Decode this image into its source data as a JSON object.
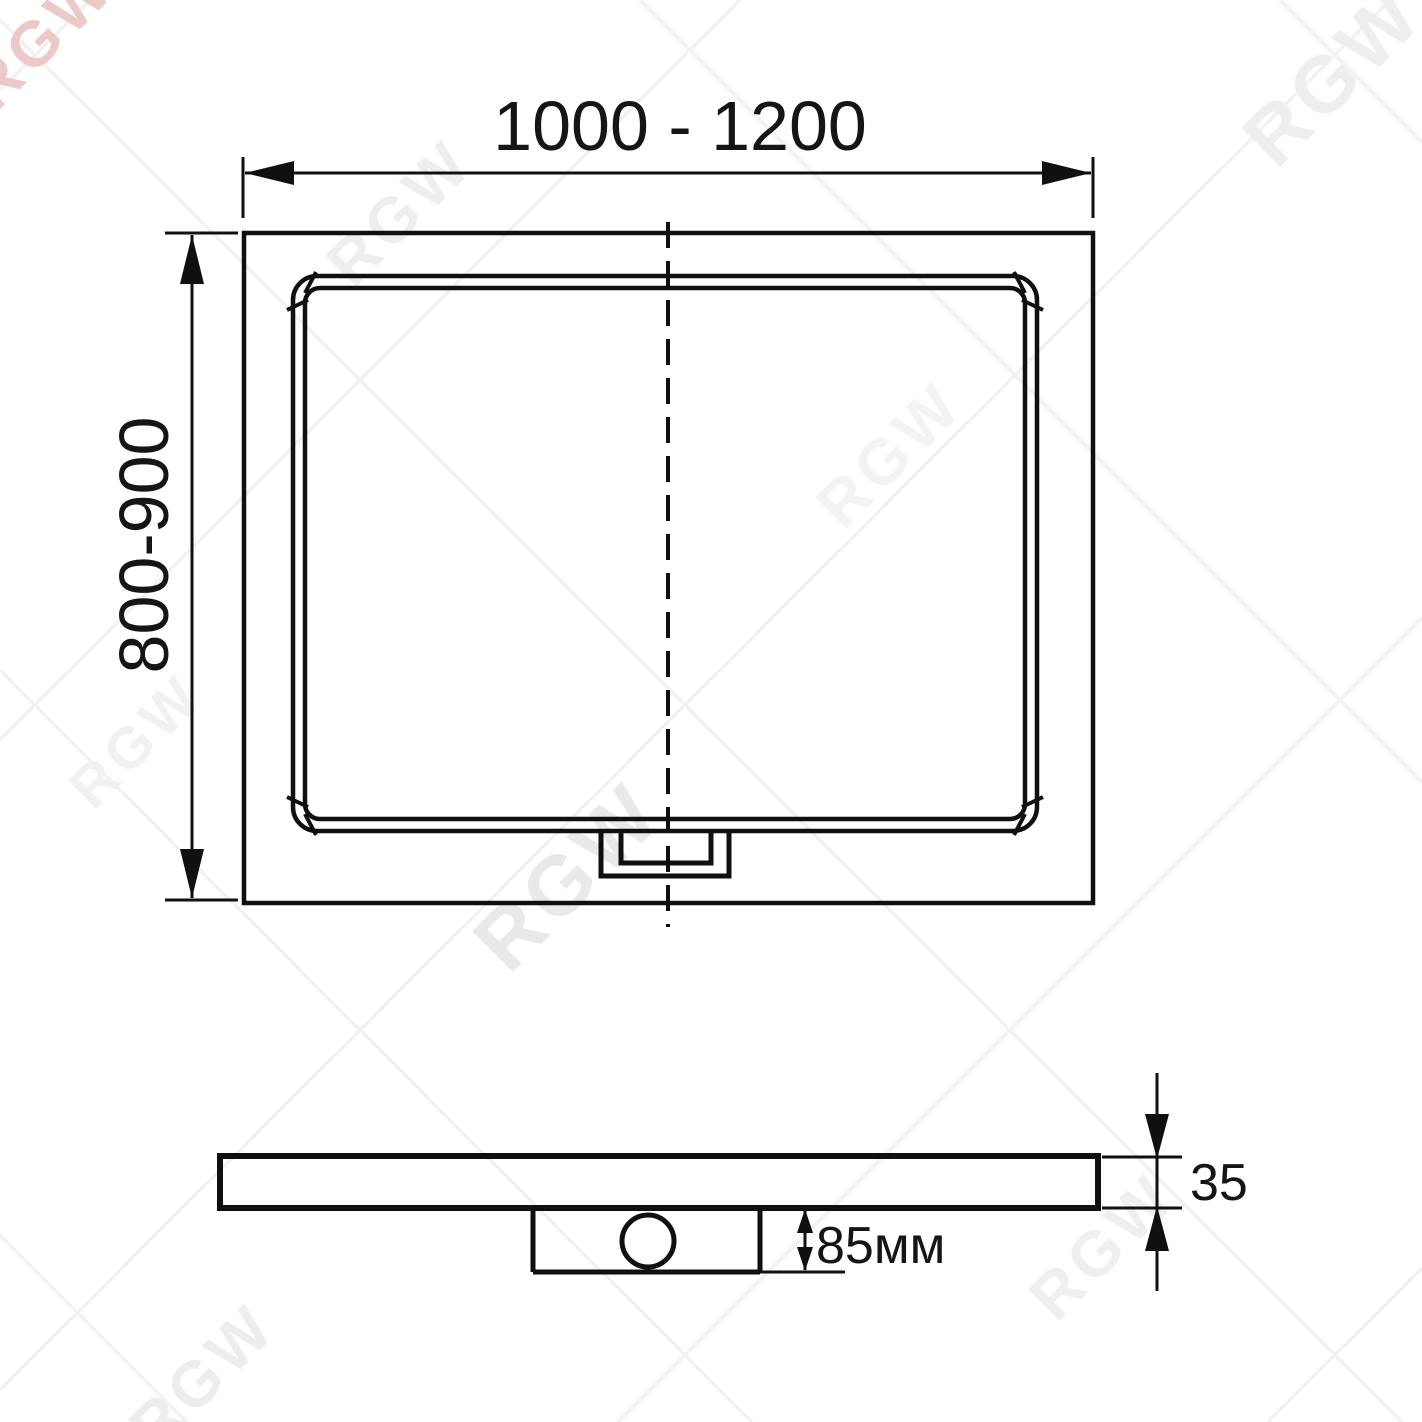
{
  "watermark": {
    "text": "RGW",
    "accent_color": "#ecc9c9",
    "gray_color": "#efeded"
  },
  "top_view": {
    "width_label": "1000 - 1200",
    "width_min_mm": 1000,
    "width_max_mm": 1200,
    "depth_label": "800-900",
    "depth_min_mm": 800,
    "depth_max_mm": 900
  },
  "side_view": {
    "thickness_label": "35",
    "thickness_mm": 35,
    "drain_depth_label": "85мм",
    "drain_depth_mm": 85
  }
}
